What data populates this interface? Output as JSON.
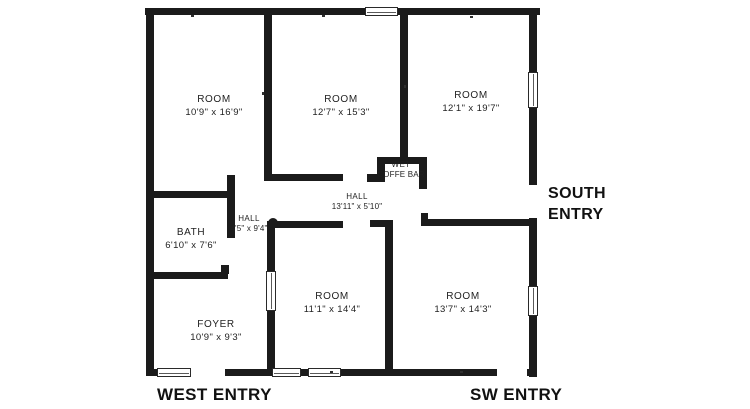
{
  "floorplan": {
    "rooms": [
      {
        "name": "ROOM",
        "dims": "10'9\" x 16'9\""
      },
      {
        "name": "ROOM",
        "dims": "12'7\" x 15'3\""
      },
      {
        "name": "ROOM",
        "dims": "12'1\" x 19'7\""
      },
      {
        "name": "WET",
        "dims": "COFFE BAR"
      },
      {
        "name": "HALL",
        "dims": "13'11\" x 5'10\""
      },
      {
        "name": "HALL",
        "dims": "4'5\" x 9'4\""
      },
      {
        "name": "BATH",
        "dims": "6'10\" x 7'6\""
      },
      {
        "name": "FOYER",
        "dims": "10'9\" x 9'3\""
      },
      {
        "name": "ROOM",
        "dims": "11'1\" x 14'4\""
      },
      {
        "name": "ROOM",
        "dims": "13'7\" x 14'3\""
      }
    ],
    "entries": {
      "south_line1": "SOUTH",
      "south_line2": "ENTRY",
      "west": "WEST ENTRY",
      "sw": "SW ENTRY"
    },
    "colors": {
      "wall": "#1b1b1b",
      "background": "#ffffff",
      "text": "#1b1b1b"
    }
  }
}
